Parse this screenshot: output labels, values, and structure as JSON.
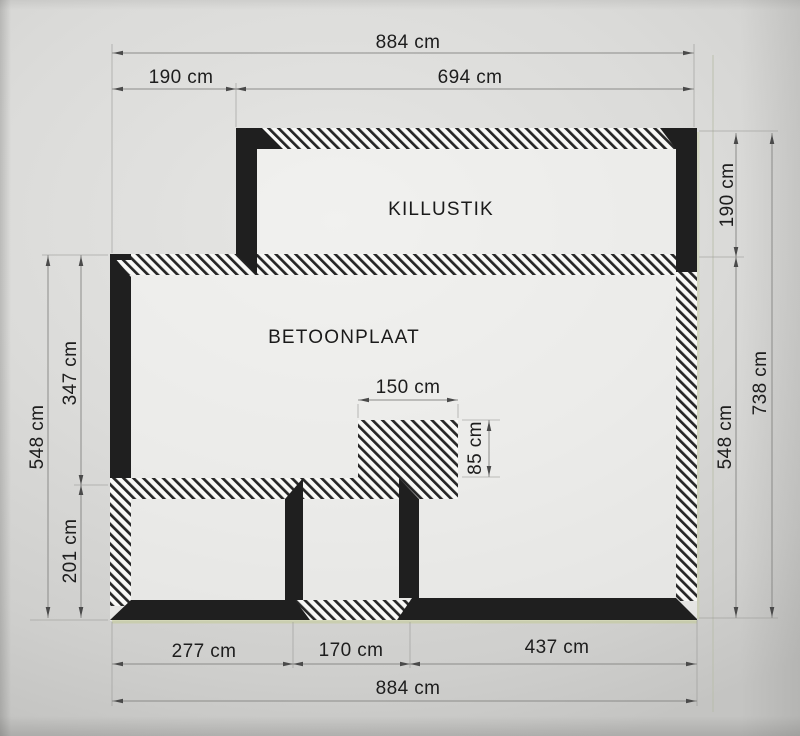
{
  "plan": {
    "unit": "cm",
    "room_labels": {
      "upper": "KILLUSTIK",
      "main": "BETOONPLAAT"
    },
    "dimensions": {
      "top": {
        "overall": "884 cm",
        "left_offset": "190 cm",
        "right_span": "694 cm"
      },
      "bottom": {
        "left_room": "277 cm",
        "opening": "170 cm",
        "right_section": "437 cm",
        "overall": "884 cm"
      },
      "left": {
        "overall": "548 cm",
        "upper": "347 cm",
        "lower": "201 cm"
      },
      "right": {
        "upper": "190 cm",
        "lower": "548 cm",
        "overall": "738 cm"
      },
      "notch": {
        "width": "150 cm",
        "depth": "85 cm"
      }
    },
    "colors": {
      "wall_fill": "#1f1f1f",
      "paper": "#d7d7d5",
      "dimension_line": "#8f8f8f",
      "label_text": "#1d1d1d",
      "highlight_line": "#c3cb96"
    }
  }
}
